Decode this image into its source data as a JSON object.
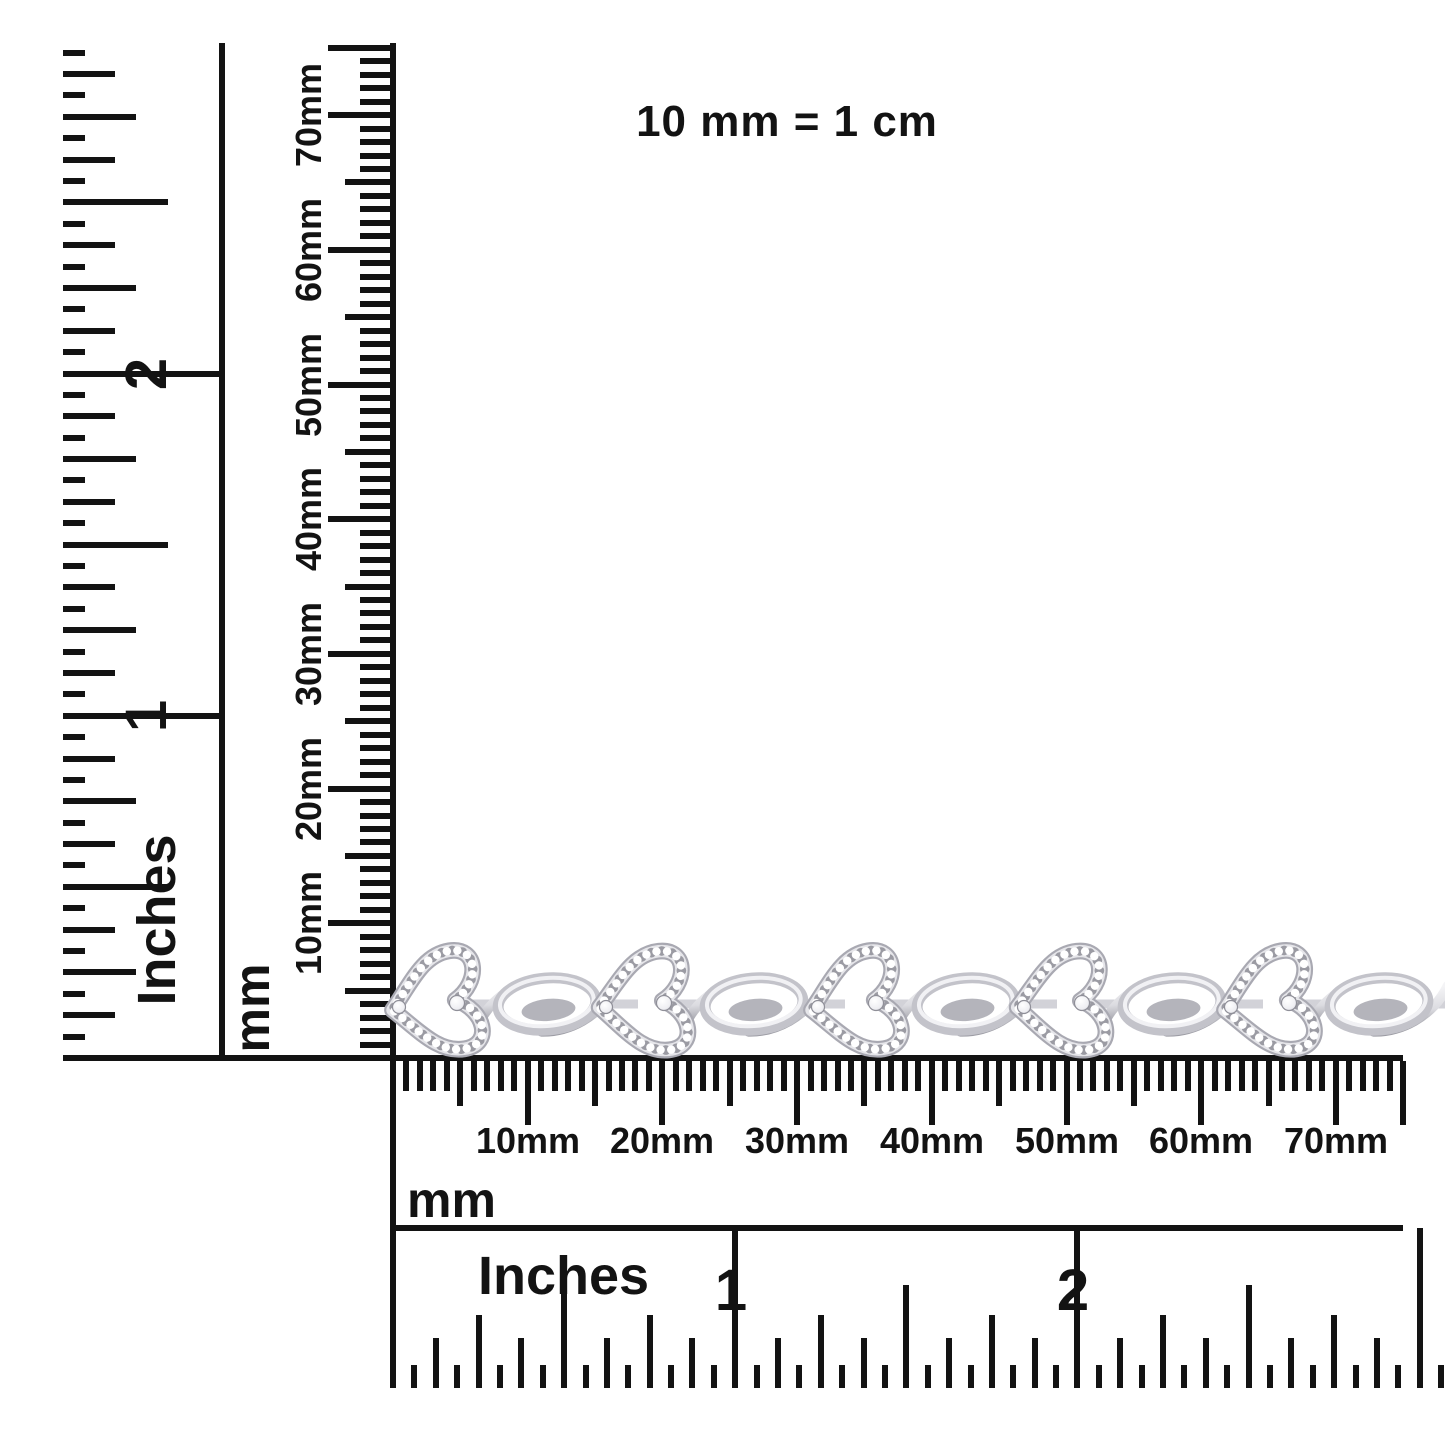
{
  "scale_note": "10 mm = 1 cm",
  "colors": {
    "ink": "#131313",
    "background": "#ffffff",
    "metal_outline": "#a9a9b2",
    "metal_light": "#f4f4f6",
    "metal_mid": "#dcdce1",
    "metal_shadow": "#9c9ca4",
    "diamond": "#ffffff"
  },
  "rulers": {
    "vertical_inches": {
      "unit": "Inches",
      "number_labels": [
        "1",
        "2"
      ],
      "ticks_per_inch": 16,
      "extent_sixteenths": 47
    },
    "vertical_mm": {
      "unit": "mm",
      "major_labels": [
        "10mm",
        "20mm",
        "30mm",
        "40mm",
        "50mm",
        "60mm",
        "70mm"
      ],
      "extent_mm": 75
    },
    "horizontal_mm": {
      "unit": "mm",
      "major_labels": [
        "10mm",
        "20mm",
        "30mm",
        "40mm",
        "50mm",
        "60mm",
        "70mm"
      ],
      "extent_mm": 75
    },
    "horizontal_inches": {
      "unit": "Inches",
      "number_labels": [
        "1",
        "2"
      ],
      "ticks_per_inch": 16,
      "extent_sixteenths": 49
    }
  },
  "bracelet": {
    "kind": "open-heart and infinity twist link bracelet in white metal with pave diamonds",
    "heart_link_count": 5,
    "twist_link_count": 5,
    "heart_centers_x": [
      443,
      650,
      862,
      1068,
      1275
    ],
    "center_y": 1002,
    "approx_length_shown_mm": 75
  }
}
